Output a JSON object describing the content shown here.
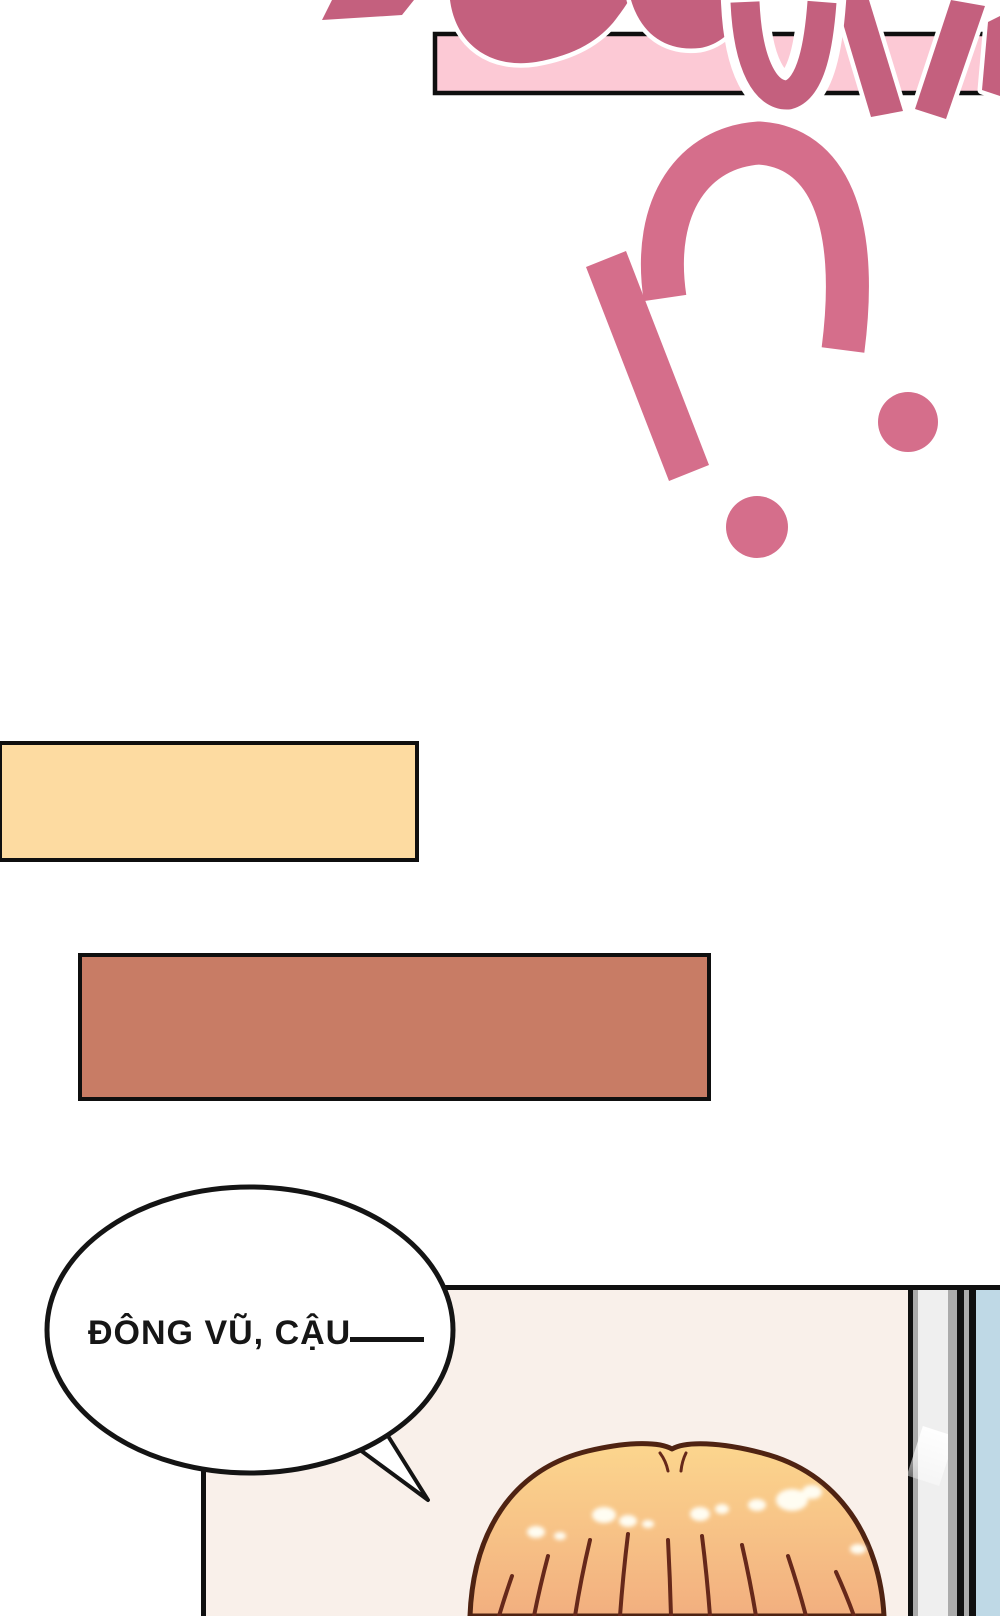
{
  "page": {
    "width": 1000,
    "height": 1616,
    "background": "#ffffff"
  },
  "sfx": {
    "description": "large scream sound-effect letters cut off by top edge of page",
    "box_fill": "#FCC9D5",
    "letter_fill": "#C4607E",
    "letter_outline": "#FFFFFF",
    "border_color": "#0f0f0f"
  },
  "interrobang": {
    "glyph": "!?",
    "fill": "#D56E8B"
  },
  "captions": {
    "cream_fill": "#FDDBA1",
    "brown_fill": "#C87C65",
    "border_color": "#0f0f0f"
  },
  "speech": {
    "text": "ĐÔNG VŨ, CẬU",
    "dash_color": "#141414",
    "bubble_fill": "#FFFFFF",
    "bubble_border": "#141414"
  },
  "panel": {
    "border_color": "#101010",
    "interior_fill": "#F9F0EA",
    "wall_fill": "#BFD9E6",
    "door_gray": "#ABABAB",
    "door_light": "#EFEFEF"
  },
  "character": {
    "hair_top": "#FCD68E",
    "hair_bottom": "#F2AF7F",
    "hair_outline": "#4F2312",
    "hair_strand": "#66281A",
    "shine": "#FFFDF2"
  }
}
